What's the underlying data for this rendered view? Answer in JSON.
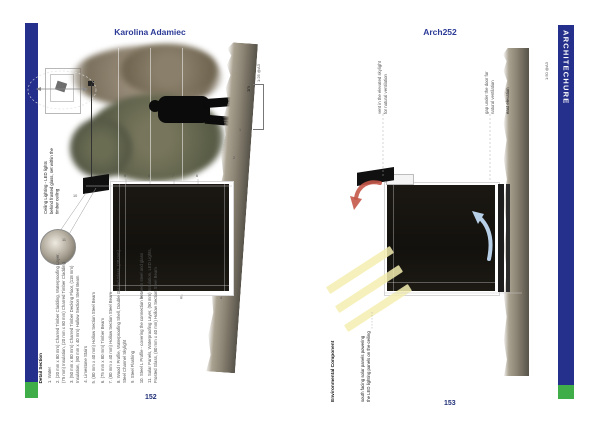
{
  "colors": {
    "accent_blue": "#2b3a96",
    "page_num_blue": "#1f2f77",
    "bar_blue": "#252f8c",
    "bar_green": "#3fae49",
    "arrow_red": "#c4584a",
    "arrow_blue": "#b8cfe8",
    "sun_yellow": "#f5eeb0"
  },
  "spread": {
    "left_header": "Karolina Adamiec",
    "right_header": "Arch252",
    "left_page_number": "152",
    "right_page_number": "153",
    "side_tab": "ARCHITECHURE"
  },
  "left_page": {
    "scale_ratio": "1:25 @A3",
    "scale_bar": "1m",
    "detail_note": "Ceiling Lighting - LED lights behind frosted glass, set within the timber ceiling",
    "legend_title": "Detail Section",
    "legend_items": [
      "1. Water",
      "2. (20 mm x 80 mm) Charred Timber Cladding, Waterproofing Layer, (75 mm) Insulation, (20 mm x 80 mm) Charred Timber Cladding",
      "3. (50 mm x 80 mm) Charred Timber Decking Floor, (118 mm) Insulation, (80 mm x 40 mm) Hollow Section Steel Beam",
      "4. Limestone Stairs",
      "5. (80 mm x 40 mm) Hollow Section Steel Beam",
      "6. (75 mm x 80 mm) Timber Beam",
      "7. (80 mm x 40 mm) Hollow Section Steel Beam",
      "8. Wood I Profile, Waterproofing Shell, Double Glazed Glass, (20 mm) Steel Channel Skylight",
      "9. Steel Flashing",
      "10. Steel L Profile - covering the connection between steel and glass",
      "11. Solar Panels, Waterproofing Layer, (50 mm) Insulation, LED Lights, Frosted Glass, (80 mm x 40 mm) Hollow Section Steel Beam"
    ],
    "leader_numbers": [
      "1",
      "2",
      "3",
      "4",
      "5",
      "6",
      "7",
      "8",
      "9",
      "10",
      "11"
    ]
  },
  "right_page": {
    "section_title": "Environmental Component",
    "note_solar": "south facing solar panels powering the LED lighting panels on the ceiling",
    "note_vent": "vent in the elevated skylight for natural ventilation",
    "note_door": "gap under the door for natural ventilation",
    "elevation_label": "east elevation",
    "scale_ratio": "1:50 @A3"
  }
}
